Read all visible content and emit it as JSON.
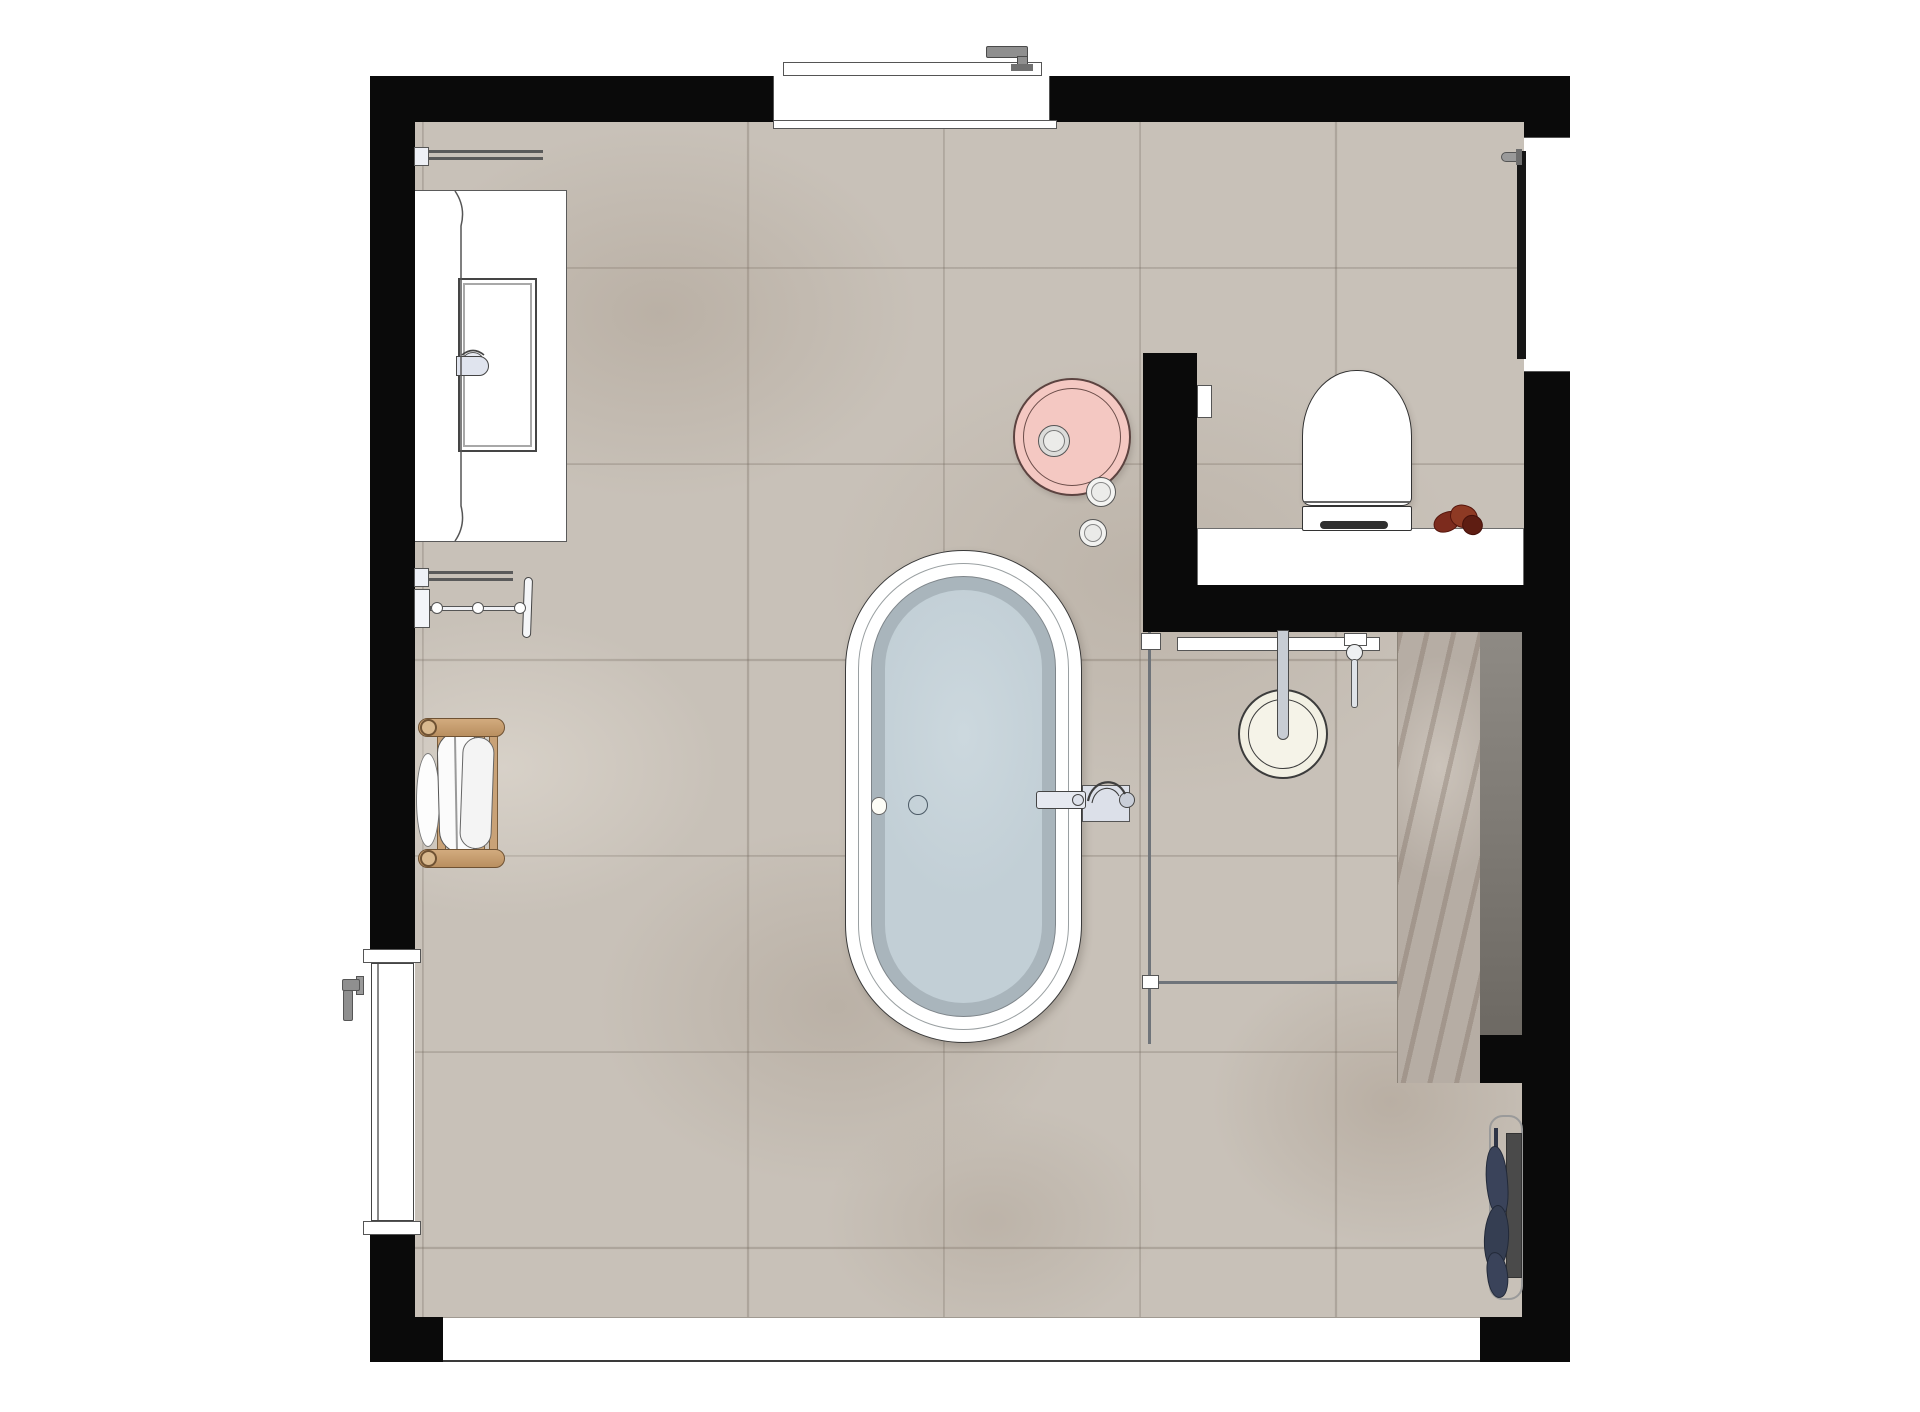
{
  "meta": {
    "view": "bathroom-floor-plan-top-view",
    "room": "bathroom"
  },
  "palette": {
    "wall": "#0a0a0a",
    "floor": "#c8c1b8",
    "outline": "#4a4a4a",
    "white": "#ffffff",
    "tub_rim": "#9aa0a2",
    "tub_basin": "#a9b5bc",
    "tub_water": "#c2cfd6",
    "fixture_gray": "#e0e4ee",
    "metal": "#8f8f8f",
    "wood": "#c9a277",
    "wood_dark": "#6f5233",
    "towel_navy": "#3a435a",
    "pink": "#f4c8c2",
    "pink_outline": "#5c4340",
    "cream": "#f2f0e3",
    "radiator": "#4a4a4a",
    "chrome": "#9a9a9a",
    "strip_dark_top": "#8e8a84",
    "strip_dark_bottom": "#6d6963",
    "strip_veined": "#b6ada4",
    "plant": "#7c2b1d",
    "glass": "#6f747a"
  },
  "fixtures": [
    {
      "name": "window-north",
      "kind": "window with handle, top wall"
    },
    {
      "name": "window-east",
      "kind": "window with sash and handle, right wall"
    },
    {
      "name": "entry-door",
      "kind": "flush door in left wall with lever handle"
    },
    {
      "name": "vanity-counter",
      "kind": "wall-hung vanity with rectangular sink and faucet"
    },
    {
      "name": "towel-rail-upper",
      "kind": "wall towel rail"
    },
    {
      "name": "towel-rail-lower",
      "kind": "wall towel rail"
    },
    {
      "name": "towel-arm",
      "kind": "swing towel holder with three knobs"
    },
    {
      "name": "wooden-towel-rack",
      "kind": "wood ladder rack with white towel"
    },
    {
      "name": "bathtub",
      "kind": "freestanding oval tub with water"
    },
    {
      "name": "tub-faucet",
      "kind": "wall-mounted tub filler with plate, spout and handle"
    },
    {
      "name": "pink-stool",
      "kind": "round scalloped side stool with cup and two jars"
    },
    {
      "name": "toilet",
      "kind": "wall-hung toilet on ledge"
    },
    {
      "name": "flush-plate",
      "kind": "in-wall flush plate"
    },
    {
      "name": "plant",
      "kind": "small red plant on ledge"
    },
    {
      "name": "rain-shower-head",
      "kind": "ceiling rain shower, round"
    },
    {
      "name": "hand-shower",
      "kind": "hand shower on rail"
    },
    {
      "name": "shower-glass",
      "kind": "fixed glass screen with floor track"
    },
    {
      "name": "towel-radiator",
      "kind": "vertical radiator with navy towel"
    }
  ]
}
